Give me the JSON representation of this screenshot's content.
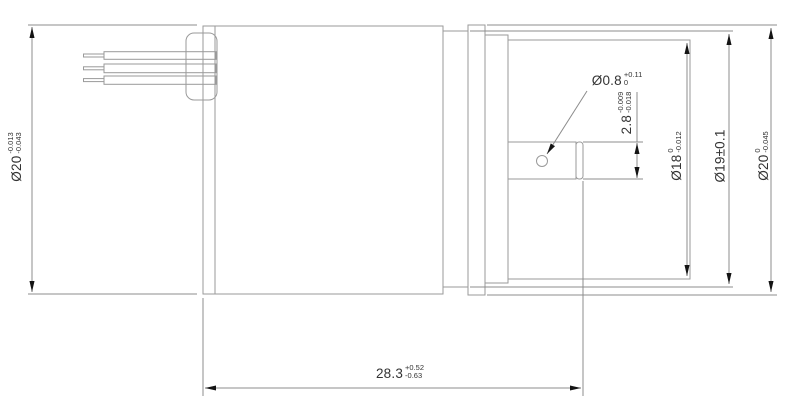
{
  "drawing": {
    "type": "technical-dimension-drawing",
    "subject": "dc-micromotor-with-gearhead-side-view"
  },
  "dimensions": {
    "motor_od": {
      "value": "Ø20",
      "tol_upper": "-0.013",
      "tol_lower": "-0.043"
    },
    "hole": {
      "value": "Ø0.8",
      "tol_upper": "+0.11",
      "tol_lower": "0"
    },
    "shaft_flat": {
      "value": "2.8",
      "tol_upper": "-0.009",
      "tol_lower": "-0.018"
    },
    "bore": {
      "value": "Ø18",
      "tol_upper": "0",
      "tol_lower": "-0.012"
    },
    "pilot": {
      "value": "Ø19±0.1"
    },
    "gearbox_od": {
      "value": "Ø20",
      "tol_upper": "0",
      "tol_lower": "-0.045"
    },
    "length": {
      "value": "28.3",
      "tol_upper": "+0.52",
      "tol_lower": "-0.63"
    }
  },
  "colors": {
    "outline": "#9a9a9a",
    "dimension_line": "#8c8c8c",
    "arrowhead": "#141414",
    "text": "#333333",
    "background": "#ffffff"
  }
}
